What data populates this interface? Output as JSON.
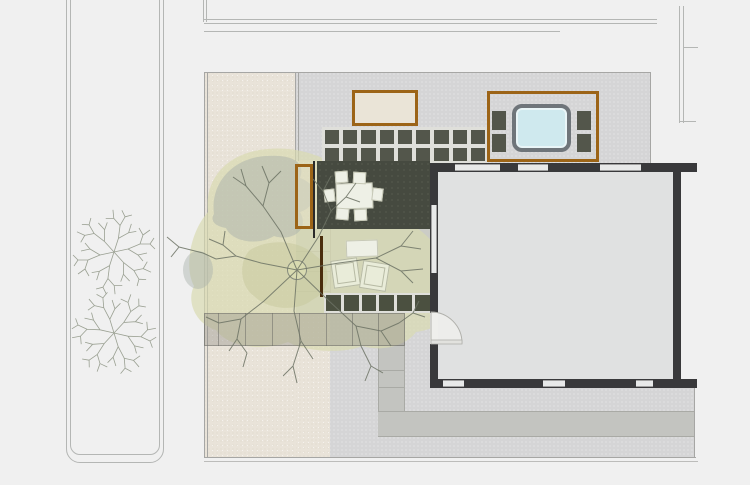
{
  "plan": {
    "kind": "residential site plan, top view",
    "visible_text": "",
    "features": [
      "street median with two trees",
      "sand yard",
      "gravel yard",
      "large shade tree with canopy",
      "wood planter",
      "paver grid",
      "hot tub platform",
      "dining deck with table and six chairs",
      "two lounge chairs with side table",
      "paver walkway",
      "concrete path",
      "building footprint with windows and entry door"
    ]
  },
  "counts": {
    "street_trees": 2,
    "dining_chairs": 6,
    "lounge_chairs": 2,
    "top_wall_windows": 3,
    "bottom_wall_windows": 3
  },
  "grids": {
    "top_paver_grid": {
      "cols": 9,
      "rows": 2
    },
    "lounge_paver_row": {
      "cols": 6,
      "rows": 1
    },
    "platform_paver_column": {
      "cols": 1,
      "rows": 2
    }
  },
  "colors": {
    "bg": "#f0f0f0",
    "street_line": "#b4b6b4",
    "tree_line": "#9aa092",
    "border_line": "#a6a6a4",
    "outer_line": "#bcbcba",
    "sand": "#e9e3d9",
    "gravel": "#d5d5d6",
    "concrete": "#c3c4c0",
    "path_edge": "#a9aaa5",
    "walkway_fill": "rgba(148,146,138,0.40)",
    "walkway_line": "rgba(110,110,104,0.55)",
    "canopy": "#d8dab0",
    "canopy_patch": "#a9b2ab",
    "canopy_olive": "#c6c79c",
    "branch": "#6d7365",
    "trunk_stroke": "#858a7c",
    "deck": "#464a40",
    "deck_edge": "#2a2a2a",
    "wood": "#9c6417",
    "screen_wood": "#4a2d0d",
    "bench_fill": "rgba(224,220,196,0.55)",
    "paver_dark": "#53564b",
    "paver_green": "#4b5040",
    "paver_bed": "#dfdfda",
    "planter_fill": "#eae4d7",
    "water": "#cfe9ee",
    "tub_border": "#6f757a",
    "wall": "#39393b",
    "interior": "#e0e1e1",
    "window": "#e8e9e9",
    "window_line": "#a0a0a0",
    "furniture_white": "#eef0e6",
    "furniture_edge": "#c6c8b6",
    "lounge_fill": "#e9ecd9",
    "lounge_edge": "#b7baa4",
    "lounge_bg": "#cbccc6",
    "door_fill": "#efefec",
    "door_line": "#b0b0ab"
  }
}
